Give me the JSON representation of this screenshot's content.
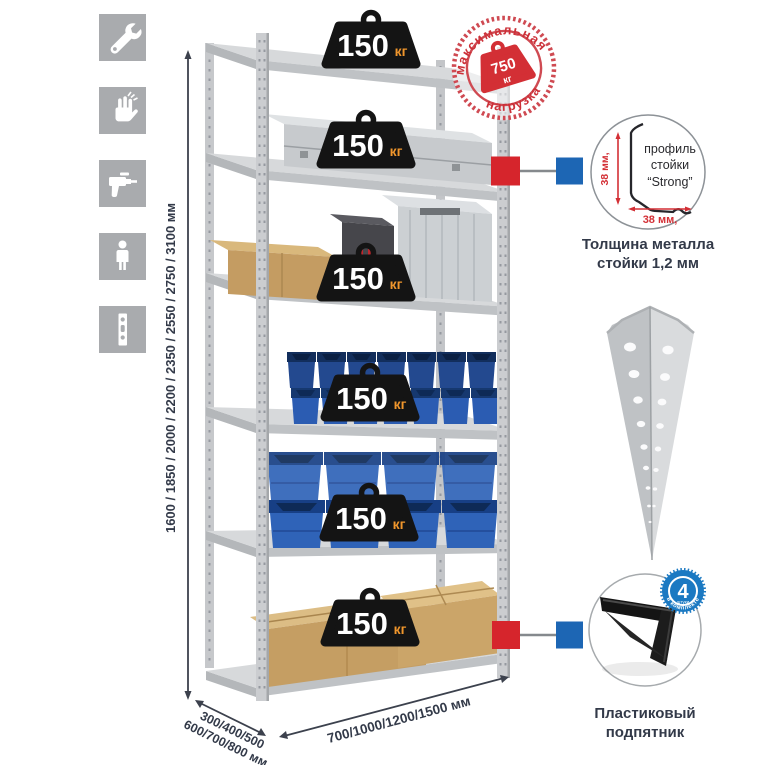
{
  "icons_panel": {
    "items": [
      {
        "name": "wrench"
      },
      {
        "name": "gloves"
      },
      {
        "name": "drill"
      },
      {
        "name": "person"
      },
      {
        "name": "perforated-post"
      }
    ]
  },
  "height_dimension": {
    "label": "1600 / 1850 / 2000 / 2200 / 2350 / 2550 / 2750 / 3100 мм"
  },
  "rack": {
    "shelf_loads": [
      {
        "value": "150",
        "unit": "кг"
      },
      {
        "value": "150",
        "unit": "кг"
      },
      {
        "value": "150",
        "unit": "кг"
      },
      {
        "value": "150",
        "unit": "кг"
      },
      {
        "value": "150",
        "unit": "кг"
      },
      {
        "value": "150",
        "unit": "кг"
      }
    ]
  },
  "max_load_stamp": {
    "arc_top": "максимальная",
    "arc_bottom": "нагрузка",
    "value": "750",
    "unit": "кг"
  },
  "profile_detail": {
    "label_line1": "профиль",
    "label_line2": "стойки",
    "label_line3": "“Strong”",
    "dim_vertical": "38 мм,",
    "dim_horizontal": "38 мм,",
    "caption_line1": "Толщина металла",
    "caption_line2": "стойки 1,2 мм"
  },
  "foot_detail": {
    "badge_value": "4",
    "badge_small_text": "штуки",
    "badge_ring_text": "в комплекте",
    "caption_line1": "Пластиковый",
    "caption_line2": "подпятник"
  },
  "depth_dimension": {
    "line1": "300/400/500",
    "line2": "600/700/800 мм"
  },
  "width_dimension": {
    "label": "700/1000/1200/1500 мм"
  },
  "colors": {
    "accent_red": "#d32f35",
    "accent_blue": "#1d66b4",
    "navy_text": "#333a49",
    "metal_gray": "#c9cbce",
    "bin_blue": "#2f63b8",
    "cardboard": "#c59e63",
    "badge_black": "#141414",
    "badge_orange": "#f0962c",
    "icon_gray": "#a9abae"
  }
}
